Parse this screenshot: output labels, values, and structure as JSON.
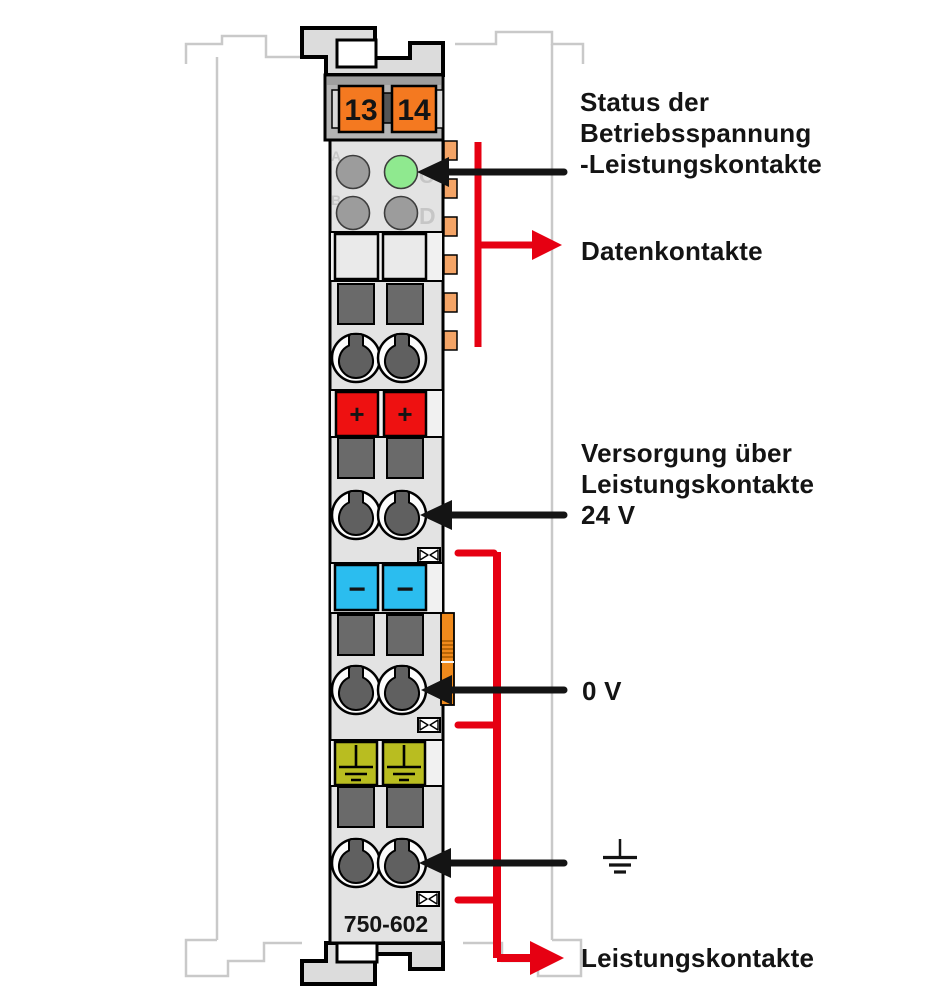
{
  "diagram": {
    "module": {
      "part_number": "750-602",
      "terminal_numbers": [
        "13",
        "14"
      ],
      "led_labels": [
        "A",
        "B",
        "C",
        "D"
      ],
      "polarity_markings": {
        "positive": "+",
        "negative": "−"
      }
    },
    "callouts": {
      "status": {
        "lines": [
          "Status der",
          "Betriebsspannung",
          "-Leistungskontakte"
        ]
      },
      "data_contacts": {
        "label": "Datenkontakte"
      },
      "supply": {
        "lines": [
          "Versorgung über",
          "Leistungskontakte",
          "24 V"
        ]
      },
      "zero_volt": {
        "label": "0 V"
      },
      "power_contacts": {
        "label": "Leistungskontakte"
      }
    },
    "icons": {
      "ground": "earth-ground-icon",
      "status_pointer": "black-arrow-left-icon",
      "data_contacts_pointer": "red-arrow-right-icon",
      "power_contacts_pointer": "red-arrow-right-icon",
      "jumper_contact": "power-jumper-contact-icon"
    },
    "colors": {
      "arrow_black": "#141414",
      "arrow_red": "#e60012",
      "terminal_orange": "#f47920",
      "terminal_red": "#ee1111",
      "terminal_blue": "#2bbdef",
      "terminal_ground_green": "#b9bd20",
      "led_green": "#8fe98f",
      "led_gray": "#9c9c9c",
      "module_body_gray": "#e3e3e3",
      "module_head_gray": "#b4b4b4",
      "data_tab_orange": "#f4a466",
      "latch_orange": "#f08a1c",
      "neighbor_outline_gray": "#c9c9c9"
    }
  }
}
